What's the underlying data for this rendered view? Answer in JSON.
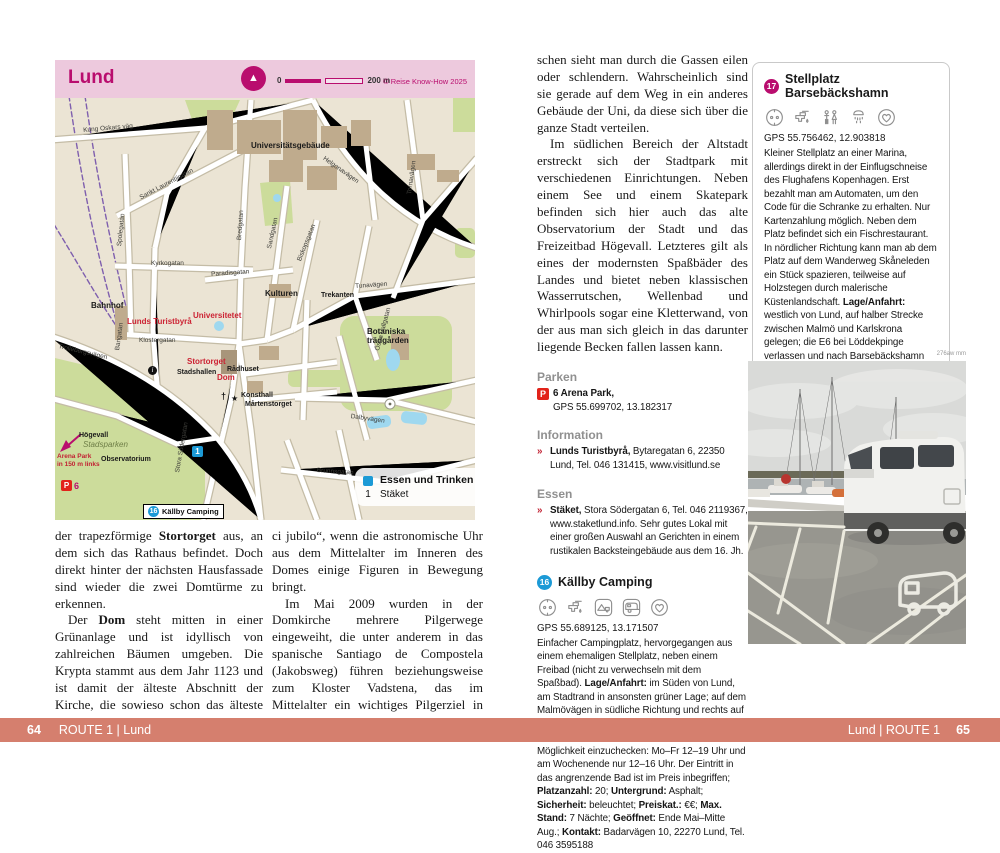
{
  "colors": {
    "brand_magenta": "#b90d6e",
    "map_header_pink": "#edc9dd",
    "footer_salmon": "#d57f6e",
    "accent_red": "#c22233",
    "marker_blue": "#1c9ad6"
  },
  "map": {
    "title": "Lund",
    "scale_start": "0",
    "scale_end": "200 m",
    "credit": "© Reise Know-How 2025",
    "compass": "N",
    "legend": {
      "title": "Essen und Trinken",
      "entry_num": "1",
      "entry_label": "Stäket"
    },
    "callout": {
      "num": "16",
      "label": "Källby Camping"
    },
    "p6": {
      "p": "P",
      "num": "6"
    },
    "marker1": "1",
    "info_i": "i",
    "church": "†",
    "star": "★",
    "labels": [
      {
        "t": "Universitätsgebäude",
        "x": 196,
        "y": 44,
        "c": "place"
      },
      {
        "t": "Kung Oskars väg",
        "x": 28,
        "y": 30,
        "c": "street",
        "r": -5
      },
      {
        "t": "Bahnhof",
        "x": 36,
        "y": 204,
        "c": "place"
      },
      {
        "t": "Lunds Turistbyrå",
        "x": 72,
        "y": 220,
        "c": "poi"
      },
      {
        "t": "Universitetet",
        "x": 138,
        "y": 214,
        "c": "poi"
      },
      {
        "t": "Dom",
        "x": 162,
        "y": 276,
        "c": "poi"
      },
      {
        "t": "Kulturen",
        "x": 210,
        "y": 192,
        "c": "place"
      },
      {
        "t": "Trekanten",
        "x": 266,
        "y": 194,
        "c": "place-sm"
      },
      {
        "t": "Botaniska",
        "x": 312,
        "y": 230,
        "c": "place"
      },
      {
        "t": "trädgården",
        "x": 312,
        "y": 239,
        "c": "place"
      },
      {
        "t": "Stortorget",
        "x": 132,
        "y": 260,
        "c": "poi"
      },
      {
        "t": "Stadshallen",
        "x": 122,
        "y": 271,
        "c": "place-sm"
      },
      {
        "t": "Rådhuset",
        "x": 172,
        "y": 268,
        "c": "place-sm"
      },
      {
        "t": "Konsthall",
        "x": 186,
        "y": 294,
        "c": "place-sm"
      },
      {
        "t": "Mårtenstorget",
        "x": 190,
        "y": 303,
        "c": "place-sm"
      },
      {
        "t": "Högevall",
        "x": 24,
        "y": 334,
        "c": "place-sm"
      },
      {
        "t": "Observatorium",
        "x": 46,
        "y": 358,
        "c": "place-sm"
      },
      {
        "t": "Stadsparken",
        "x": 28,
        "y": 343,
        "c": "park-label"
      },
      {
        "t": "Arena Park",
        "x": 2,
        "y": 356,
        "c": "red-label"
      },
      {
        "t": "in 150 m links",
        "x": 2,
        "y": 364,
        "c": "red-label"
      },
      {
        "t": "Sankt Laurentiigatan",
        "x": 84,
        "y": 98,
        "c": "street",
        "r": -28
      },
      {
        "t": "Spolegatan",
        "x": 62,
        "y": 148,
        "c": "street",
        "r": -84
      },
      {
        "t": "Bredgatan",
        "x": 182,
        "y": 142,
        "c": "street",
        "r": -86
      },
      {
        "t": "Kyrkogatan",
        "x": 96,
        "y": 163,
        "c": "street"
      },
      {
        "t": "Paradisgatan",
        "x": 156,
        "y": 174,
        "c": "street",
        "r": -4
      },
      {
        "t": "Sandgatan",
        "x": 212,
        "y": 150,
        "c": "street",
        "r": -78
      },
      {
        "t": "Biskopsgatan",
        "x": 242,
        "y": 162,
        "c": "street",
        "r": -68
      },
      {
        "t": "Helgonavägen",
        "x": 270,
        "y": 58,
        "c": "street",
        "r": 35
      },
      {
        "t": "Tornavägen",
        "x": 352,
        "y": 96,
        "c": "street",
        "r": -82
      },
      {
        "t": "Tunavägen",
        "x": 300,
        "y": 186,
        "c": "street",
        "r": -4
      },
      {
        "t": "Östra Vallgatan",
        "x": 320,
        "y": 252,
        "c": "street",
        "r": -75
      },
      {
        "t": "Dalbyvägen",
        "x": 296,
        "y": 316,
        "c": "street",
        "r": 8
      },
      {
        "t": "Brunnsgatan",
        "x": 262,
        "y": 370,
        "c": "street",
        "r": 4
      },
      {
        "t": "Stora Södergatan",
        "x": 120,
        "y": 374,
        "c": "street",
        "r": -80
      },
      {
        "t": "Trollebergsvägen",
        "x": 4,
        "y": 246,
        "c": "street",
        "r": 13
      },
      {
        "t": "Bangatan",
        "x": 60,
        "y": 252,
        "c": "street",
        "r": -82
      },
      {
        "t": "Klostergatan",
        "x": 84,
        "y": 240,
        "c": "street"
      }
    ]
  },
  "left_page": {
    "columns": [
      [
        [
          {
            "t": "der trapezförmige "
          },
          {
            "t": "Stortorget",
            "b": true
          },
          {
            "t": " aus, an dem sich das Rathaus befindet. Doch direkt hinter der nächsten Hausfassade sind wieder die zwei Domtürme zu erkennen."
          }
        ],
        [
          {
            "t": "Der "
          },
          {
            "t": "Dom",
            "b": true
          },
          {
            "t": " steht mitten in einer Grünanlage und ist idyllisch von zahlreichen Bäumen umgeben. Die Krypta stammt aus dem Jahr 1123 und ist damit der älteste Abschnitt der Kirche, die sowieso schon das älteste Gebäude in der Stadt ist. Sehenswert ist das Tympanon über dem Südportal. Doch der Dom ist nicht nur was fürs Auge, sondern auch fürs Ohr. Zweimal am Tag spielt die Orgel „In dul-"
          }
        ]
      ],
      [
        [
          {
            "t": "ci jubilo“, wenn die astronomische Uhr aus dem Mittelalter im Inneren des Domes einige Figuren in Bewegung bringt."
          }
        ],
        [
          {
            "t": "Im Mai 2009 wurden in der Domkirche mehrere Pilgerwege eingeweiht, die unter anderem in das spanische Santiago de Compostela (Jakobsweg) führen beziehungsweise zum Kloster Vadstena, das im Mittelalter ein wichtiges Pilgerziel in Schweden war (siehe Route 6, S. 210)."
          }
        ],
        [
          {
            "t": "Direkt neben dem Gotteshaus ist die "
          },
          {
            "t": "Universität",
            "b": true
          },
          {
            "t": " zu sehen. Lund ist durch die Universität jung geblieben, zahlreiche junge Men-"
          }
        ]
      ]
    ]
  },
  "right_page": {
    "article": [
      [
        {
          "t": "schen sieht man durch die Gassen eilen oder schlendern. Wahrscheinlich sind sie gerade auf dem Weg in ein anderes Gebäude der Uni, da diese sich über die ganze Stadt verteilen."
        }
      ],
      [
        {
          "t": "Im südlichen Bereich der Altstadt erstreckt sich der Stadtpark mit verschiedenen Einrichtungen. Neben einem See und einem Skatepark befinden sich hier auch das alte Observatorium der Stadt und das Freizeitbad Högevall. Letzteres gilt als eines der modernsten Spaßbäder des Landes und bietet neben klassischen Wasserrutschen, Wellenbad und Whirlpools sogar eine Kletterwand, von der aus man sich gleich in das darunter liegende Becken fallen lassen kann."
        }
      ]
    ],
    "parken": {
      "heading": "Parken",
      "p": "P",
      "num_name": "6 Arena Park,",
      "gps": "GPS 55.699702, 13.182317"
    },
    "information": {
      "heading": "Information",
      "marker": "»",
      "entry": [
        {
          "t": "Lunds Turistbyrå,",
          "b": true
        },
        {
          "t": " Bytaregatan 6, 22350 Lund, Tel. 046 131415, www.visitlund.se"
        }
      ]
    },
    "essen": {
      "heading": "Essen",
      "marker": "»",
      "entry": [
        {
          "t": "Stäket,",
          "b": true
        },
        {
          "t": " Stora Södergatan 6, Tel. 046 2119367, www.staketlund.info. Sehr gutes Lokal mit einer großen Auswahl an Gerichten in einem rustikalen Backsteingebäude aus dem 16. Jh."
        }
      ]
    },
    "kallby": {
      "num": "16",
      "title": "Källby Camping",
      "gps": "GPS 55.689125, 13.171507",
      "icons": [
        "power",
        "water",
        "tent",
        "caravan",
        "favorite"
      ],
      "body": [
        {
          "t": "Einfacher Campingplatz, hervorgegangen aus einem ehemaligen Stellplatz, neben einem Freibad (nicht zu verwechseln mit dem Spaßbad). "
        },
        {
          "t": "Lage/Anfahrt:",
          "b": true
        },
        {
          "t": " im Süden von Lund, am Stadtrand in ansonsten grüner Lage; auf dem Malmövägen in südliche Richtung und rechts auf Klostergårdsvägen und Sunnanväg zum Schwimmbad. Etwas eingeschränkt ist die Möglichkeit einzuchecken: Mo–Fr 12–19 Uhr und am Wochenende nur 12–16 Uhr. Der Eintritt in das angrenzende Bad ist im Preis inbegriffen; "
        },
        {
          "t": "Platzanzahl:",
          "b": true
        },
        {
          "t": " 20; "
        },
        {
          "t": "Untergrund:",
          "b": true
        },
        {
          "t": " Asphalt; "
        },
        {
          "t": "Sicherheit:",
          "b": true
        },
        {
          "t": " beleuchtet; "
        },
        {
          "t": "Preiskat.:",
          "b": true
        },
        {
          "t": " €€; "
        },
        {
          "t": "Max. Stand:",
          "b": true
        },
        {
          "t": " 7 Nächte; "
        },
        {
          "t": "Geöffnet:",
          "b": true
        },
        {
          "t": " Ende Mai–Mitte Aug.; "
        },
        {
          "t": "Kontakt:",
          "b": true
        },
        {
          "t": " Badarvägen 10, 22270 Lund, Tel. 046 3595188"
        }
      ]
    },
    "stellplatz": {
      "num": "17",
      "title": "Stellplatz Barsebäckshamn",
      "gps": "GPS 55.756462, 12.903818",
      "icons": [
        "power",
        "water",
        "wc",
        "shower",
        "favorite"
      ],
      "body": [
        {
          "t": "Kleiner Stellplatz an einer Marina, allerdings direkt in der Einflugschneise des Flughafens Kopenhagen. Erst bezahlt man am Automaten, um den Code für die Schranke zu erhalten. Nur Kartenzahlung möglich. Neben dem Platz befindet sich ein Fischrestaurant. In nördlicher Richtung kann man ab dem Platz auf dem Wanderweg Skåneleden ein Stück spazieren, teilweise auf Holzstegen durch malerische Küstenlandschaft. "
        },
        {
          "t": "Lage/Anfahrt:",
          "b": true
        },
        {
          "t": " westlich von Lund, auf halber Strecke zwischen Malmö und Karlskrona gelegen; die E6 bei Löddekpinge verlassen und nach Barsebäckshamn fahren; "
        },
        {
          "t": "Platzanzahl:",
          "b": true
        },
        {
          "t": " 7; "
        },
        {
          "t": "Untergrund:",
          "b": true
        },
        {
          "t": " Asphalt; "
        },
        {
          "t": "Sicherheit:",
          "b": true
        },
        {
          "t": " beleuchtet, Schranke; "
        },
        {
          "t": "Preiskat.:",
          "b": true
        },
        {
          "t": " €€€; "
        },
        {
          "t": "Max. Stand:",
          "b": true
        },
        {
          "t": " unbegrenzt; "
        },
        {
          "t": "Geöffnet:",
          "b": true
        },
        {
          "t": " Mai–September; "
        },
        {
          "t": "Kontakt:",
          "b": true
        },
        {
          "t": " Skansvägen, 24657 Barsebäck, www.barsebackshamn.eu"
        }
      ]
    },
    "photo_credit": "276aw mm"
  },
  "footer": {
    "left_num": "64",
    "left_text": "ROUTE 1 | Lund",
    "right_text": "Lund | ROUTE 1",
    "right_num": "65"
  }
}
